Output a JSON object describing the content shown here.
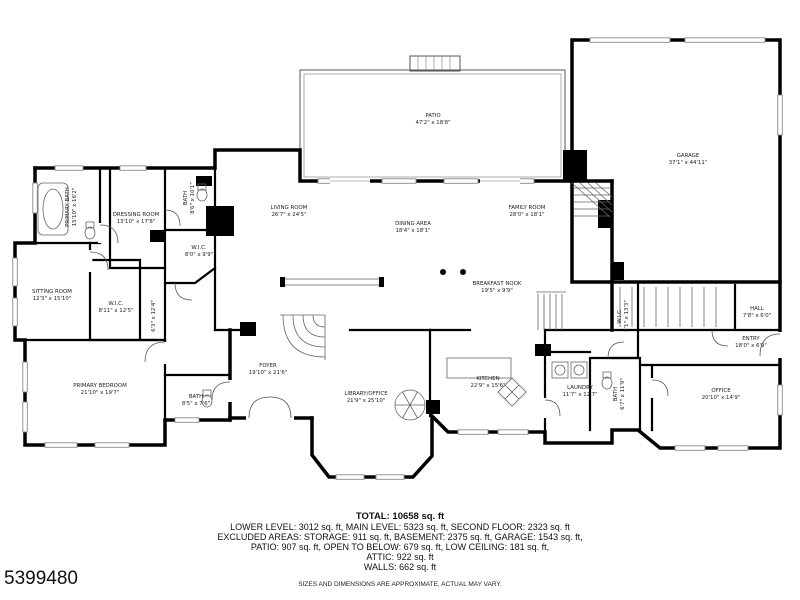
{
  "watermark": "5399480",
  "summary": {
    "total": "TOTAL: 10658 sq. ft",
    "levels": "LOWER LEVEL: 3012 sq. ft, MAIN LEVEL: 5323 sq. ft, SECOND FLOOR: 2323 sq. ft",
    "excluded1": "EXCLUDED AREAS: STORAGE: 911 sq. ft, BASEMENT: 2375 sq. ft, GARAGE: 1543 sq. ft,",
    "excluded2": "PATIO: 907 sq. ft, OPEN TO BELOW: 679 sq. ft, LOW CEILING: 181 sq. ft,",
    "attic": "ATTIC: 922 sq. ft",
    "walls": "WALLS: 662 sq. ft",
    "disclaimer": "SIZES AND DIMENSIONS ARE APPROXIMATE, ACTUAL MAY VARY."
  },
  "colors": {
    "wall": "#000000",
    "background": "#ffffff",
    "label_text": "#222222",
    "detail": "#666666"
  },
  "floor_plan": {
    "rooms": [
      {
        "name": "PATIO",
        "dims": "47'2\" x 18'8\"",
        "x": 433,
        "y": 120,
        "rotate": false
      },
      {
        "name": "GARAGE",
        "dims": "37'1\" x 44'11\"",
        "x": 688,
        "y": 160,
        "rotate": false
      },
      {
        "name": "LIVING ROOM",
        "dims": "26'7\" x 24'5\"",
        "x": 289,
        "y": 212,
        "rotate": false
      },
      {
        "name": "DINING AREA",
        "dims": "18'4\" x 18'1\"",
        "x": 413,
        "y": 228,
        "rotate": false
      },
      {
        "name": "FAMILY ROOM",
        "dims": "28'0\" x 18'1\"",
        "x": 527,
        "y": 212,
        "rotate": false
      },
      {
        "name": "BREAKFAST NOOK",
        "dims": "19'5\" x 9'9\"",
        "x": 497,
        "y": 288,
        "rotate": false
      },
      {
        "name": "KITCHEN",
        "dims": "22'9\" x 15'6\"",
        "x": 488,
        "y": 383,
        "rotate": false
      },
      {
        "name": "LAUNDRY",
        "dims": "11'7\" x 12'7\"",
        "x": 580,
        "y": 392,
        "rotate": false
      },
      {
        "name": "FOYER",
        "dims": "19'10\" x 21'6\"",
        "x": 268,
        "y": 370,
        "rotate": false
      },
      {
        "name": "LIBRARY/OFFICE",
        "dims": "21'9\" x 25'10\"",
        "x": 366,
        "y": 398,
        "rotate": false
      },
      {
        "name": "BATH",
        "dims": "8'5\" x 7'6\"",
        "x": 196,
        "y": 401,
        "rotate": false
      },
      {
        "name": "PRIMARY BEDROOM",
        "dims": "21'10\" x 19'7\"",
        "x": 100,
        "y": 390,
        "rotate": false
      },
      {
        "name": "SITTING ROOM",
        "dims": "12'3\" x 15'10\"",
        "x": 52,
        "y": 296,
        "rotate": false
      },
      {
        "name": "W.I.C.",
        "dims": "8'11\" x 12'5\"",
        "x": 116,
        "y": 308,
        "rotate": false
      },
      {
        "name": "",
        "dims": "6'3\" x 12'4\"",
        "x": 153,
        "y": 316,
        "rotate": true
      },
      {
        "name": "PRIMARY BATH",
        "dims": "15'10\" x 16'2\"",
        "x": 72,
        "y": 207,
        "rotate": true
      },
      {
        "name": "DRESSING ROOM",
        "dims": "13'10\" x 17'8\"",
        "x": 136,
        "y": 219,
        "rotate": false
      },
      {
        "name": "BATH",
        "dims": "8'6\" x 10'1\"",
        "x": 190,
        "y": 198,
        "rotate": true
      },
      {
        "name": "W.I.C.",
        "dims": "8'0\" x 9'9\"",
        "x": 199,
        "y": 252,
        "rotate": false
      },
      {
        "name": "BATH",
        "dims": "6'7\" x 11'9\"",
        "x": 620,
        "y": 394,
        "rotate": true
      },
      {
        "name": "W.I.C.",
        "dims": "5'1\" x 13'3\"",
        "x": 624,
        "y": 316,
        "rotate": true
      },
      {
        "name": "HALL",
        "dims": "7'8\" x 6'0\"",
        "x": 757,
        "y": 313,
        "rotate": false
      },
      {
        "name": "ENTRY",
        "dims": "18'0\" x 6'9\"",
        "x": 751,
        "y": 343,
        "rotate": false
      },
      {
        "name": "OFFICE",
        "dims": "20'10\" x 14'9\"",
        "x": 721,
        "y": 395,
        "rotate": false
      }
    ]
  }
}
